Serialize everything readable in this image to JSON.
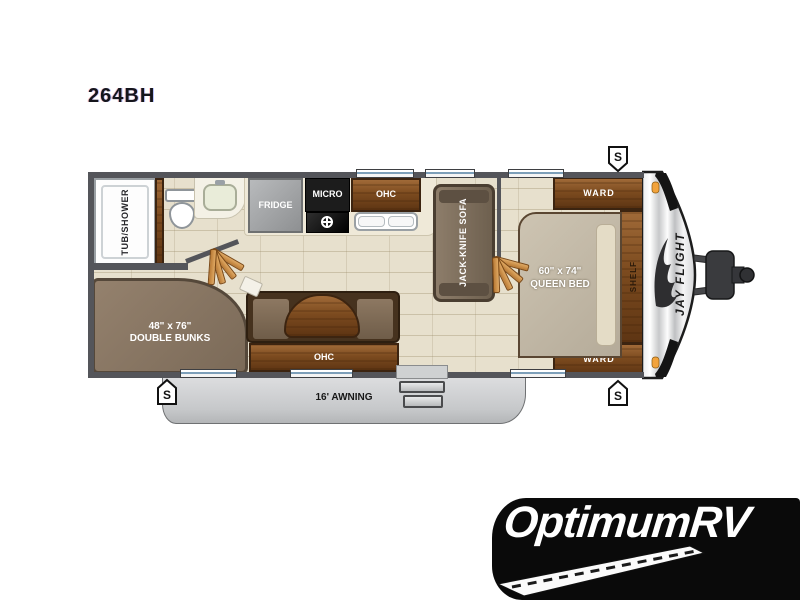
{
  "model": "264BH",
  "floorplan": {
    "speaker": "S",
    "bathroom": {
      "tub": "TUB/SHOWER"
    },
    "kitchen": {
      "fridge": "FRIDGE",
      "micro": "MICRO",
      "ohc": "OHC"
    },
    "living": {
      "sofa": "JACK-KNIFE SOFA"
    },
    "dinette": {
      "ohc": "OHC"
    },
    "bedroom": {
      "ward_top": "WARD",
      "ward_bottom": "WARD",
      "shelf": "SHELF",
      "bed_size": "60\" x 74\"",
      "bed": "QUEEN BED"
    },
    "bunkroom": {
      "size": "48\" x 76\"",
      "label": "DOUBLE BUNKS"
    },
    "exterior": {
      "awning": "16' AWNING",
      "brand": "JAY FLIGHT"
    }
  },
  "dealer": {
    "name": "OptimumRV"
  },
  "colors": {
    "wall": "#54555a",
    "floor": "#e7e0cd",
    "wood": "#7c4b1f",
    "marker_light": "#f2a33c",
    "awning": "#c6c8ca",
    "logo_bg": "#0a0a0a"
  }
}
